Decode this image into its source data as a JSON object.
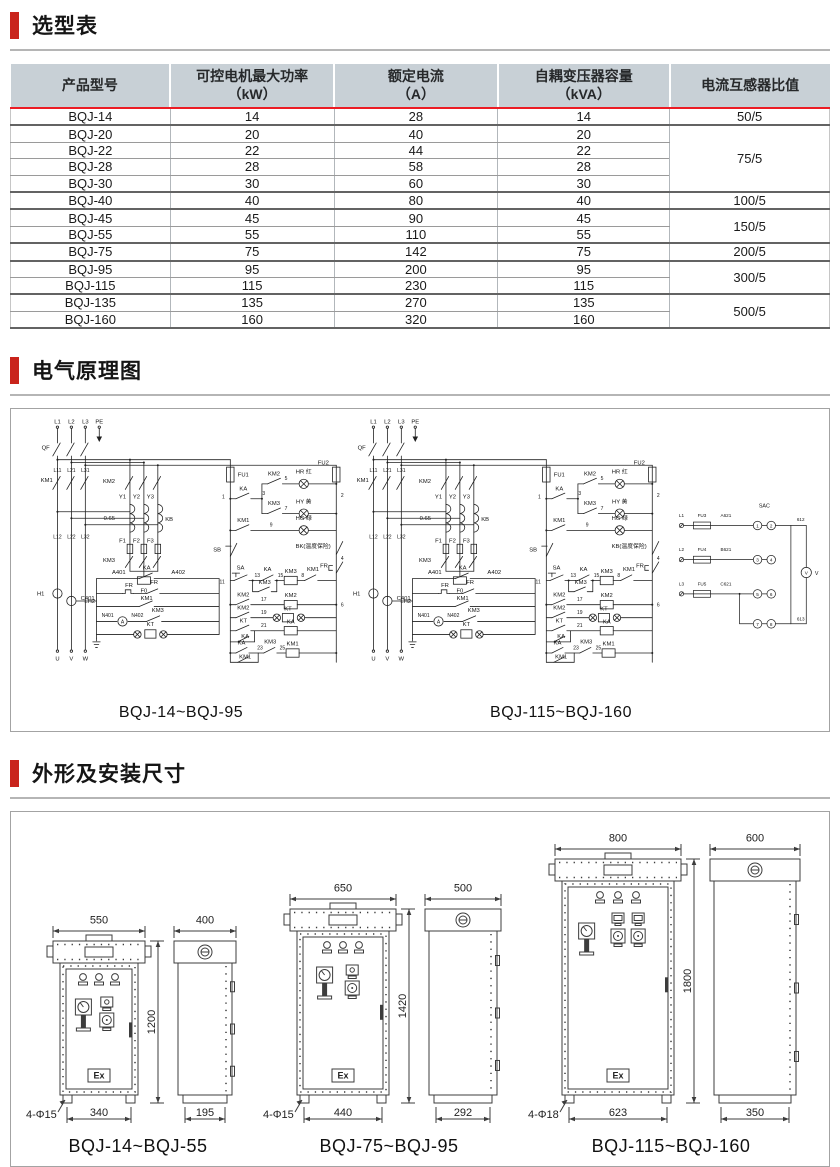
{
  "page": {
    "accent_red": "#c9241c",
    "table_header_bg": "#c8d0d6",
    "table_red_line": "#ec1c24"
  },
  "sections": {
    "selection": {
      "title": "选型表"
    },
    "schematic": {
      "title": "电气原理图"
    },
    "dimensions": {
      "title": "外形及安装尺寸"
    }
  },
  "selection_table": {
    "headers": {
      "h1": "产品型号",
      "h2a": "可控电机最大功率",
      "h2b": "（kW）",
      "h3a": "额定电流",
      "h3b": "（A）",
      "h4a": "自耦变压器容量",
      "h4b": "（kVA）",
      "h5": "电流互感器比值"
    },
    "rows": [
      {
        "model": "BQJ-14",
        "power": "14",
        "current": "28",
        "capacity": "14",
        "ratio": "50/5"
      },
      {
        "model": "BQJ-20",
        "power": "20",
        "current": "40",
        "capacity": "20",
        "ratio": "75/5"
      },
      {
        "model": "BQJ-22",
        "power": "22",
        "current": "44",
        "capacity": "22"
      },
      {
        "model": "BQJ-28",
        "power": "28",
        "current": "58",
        "capacity": "28"
      },
      {
        "model": "BQJ-30",
        "power": "30",
        "current": "60",
        "capacity": "30"
      },
      {
        "model": "BQJ-40",
        "power": "40",
        "current": "80",
        "capacity": "40",
        "ratio": "100/5"
      },
      {
        "model": "BQJ-45",
        "power": "45",
        "current": "90",
        "capacity": "45",
        "ratio": "150/5"
      },
      {
        "model": "BQJ-55",
        "power": "55",
        "current": "110",
        "capacity": "55"
      },
      {
        "model": "BQJ-75",
        "power": "75",
        "current": "142",
        "capacity": "75",
        "ratio": "200/5"
      },
      {
        "model": "BQJ-95",
        "power": "95",
        "current": "200",
        "capacity": "95",
        "ratio": "300/5"
      },
      {
        "model": "BQJ-115",
        "power": "115",
        "current": "230",
        "capacity": "115"
      },
      {
        "model": "BQJ-135",
        "power": "135",
        "current": "270",
        "capacity": "135",
        "ratio": "500/5"
      },
      {
        "model": "BQJ-160",
        "power": "160",
        "current": "320",
        "capacity": "160"
      }
    ]
  },
  "schematics": {
    "left_caption": "BQJ-14~BQJ-95",
    "right_caption": "BQJ-115~BQJ-160",
    "labels": {
      "l1": "L1",
      "l2": "L2",
      "l3": "L3",
      "pe": "PE",
      "qf": "QF",
      "km1": "KM1",
      "km2": "KM2",
      "km3": "KM3",
      "ka": "KA",
      "kt": "KT",
      "l11": "L11",
      "l21": "L21",
      "l31": "L31",
      "l12": "L12",
      "l22": "L22",
      "l32": "L32",
      "y1": "Y1",
      "y2": "Y2",
      "y3": "Y3",
      "tap": "0.65",
      "kb": "KB",
      "f1": "F1",
      "f2": "F2",
      "f3": "F3",
      "f0": "F0",
      "fu1": "FU1",
      "fu2": "FU2",
      "hr": "HR 红",
      "hy": "HY 黄",
      "hg": "HG 绿",
      "sb": "SB",
      "sa": "SA",
      "fr": "FR",
      "temp_bk": "BK(温度保险)",
      "temp_kb": "KB(温度保险)",
      "lh1": "LH1",
      "lh2": "LH2",
      "a401": "A401",
      "a402": "A402",
      "c401": "C401",
      "n401": "N401",
      "n402": "N402",
      "amp": "A",
      "u": "U",
      "v": "V",
      "w": "W",
      "n1": "1",
      "n2": "2",
      "n3": "3",
      "n4": "4",
      "n5": "5",
      "n6": "6",
      "n7": "7",
      "n8": "8",
      "n9": "9",
      "n11": "11",
      "n13": "13",
      "n15": "15",
      "n17": "17",
      "n19": "19",
      "n21": "21",
      "n23": "23",
      "n25": "25"
    },
    "meter": {
      "l1": "L1",
      "l2": "L2",
      "l3": "L3",
      "fu3": "FU3",
      "fu4": "FU4",
      "fu5": "FU5",
      "a621": "A621",
      "b621": "B621",
      "c621": "C621",
      "sac": "SAC",
      "w612": "612",
      "w613": "613",
      "v": "V",
      "t1": "1",
      "t2": "2",
      "t3": "3",
      "t4": "4",
      "t5": "5",
      "t6": "6",
      "t7": "7",
      "t8": "8"
    }
  },
  "cabinets": [
    {
      "caption": "BQJ-14~BQJ-55",
      "front_width": "550",
      "side_width": "400",
      "height": "1200",
      "front_feet": "340",
      "side_feet": "195",
      "holes": "4-Φ15",
      "ex": "Ex"
    },
    {
      "caption": "BQJ-75~BQJ-95",
      "front_width": "650",
      "side_width": "500",
      "height": "1420",
      "front_feet": "440",
      "side_feet": "292",
      "holes": "4-Φ15",
      "ex": "Ex"
    },
    {
      "caption": "BQJ-115~BQJ-160",
      "front_width": "800",
      "side_width": "600",
      "height": "1800",
      "front_feet": "623",
      "side_feet": "350",
      "holes": "4-Φ18",
      "ex": "Ex"
    }
  ]
}
